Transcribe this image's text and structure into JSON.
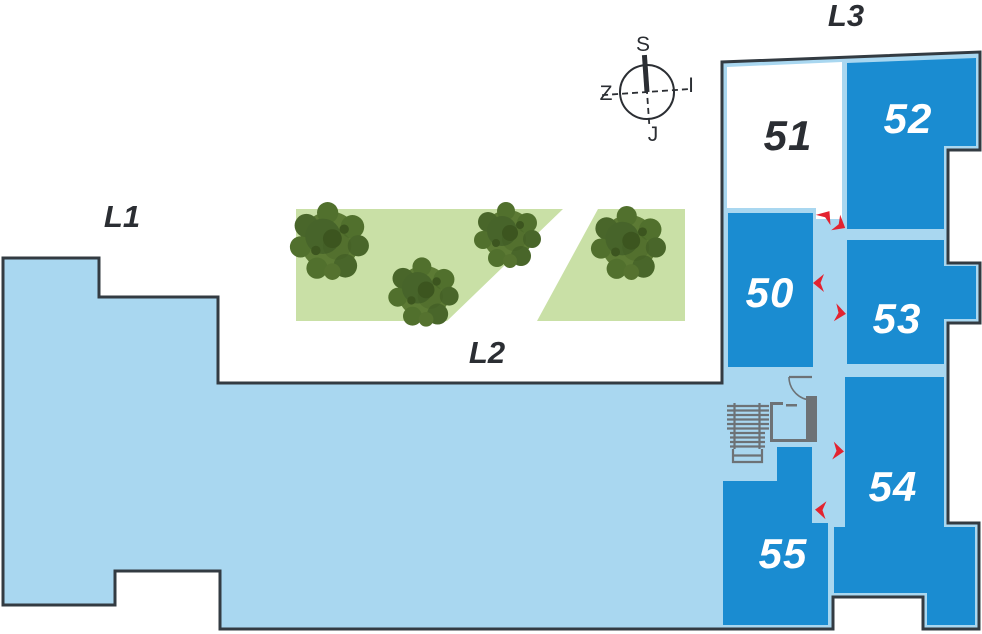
{
  "title": "Floor plan with numbered units",
  "area_labels": {
    "l1": "L1",
    "l2": "L2",
    "l3": "L3"
  },
  "compass": {
    "top": "S",
    "bottom": "J",
    "left": "Z",
    "right": "I"
  },
  "units": [
    {
      "id": "50",
      "label": "50",
      "fill": "blue"
    },
    {
      "id": "51",
      "label": "51",
      "fill": "white"
    },
    {
      "id": "52",
      "label": "52",
      "fill": "blue"
    },
    {
      "id": "53",
      "label": "53",
      "fill": "blue"
    },
    {
      "id": "54",
      "label": "54",
      "fill": "blue"
    },
    {
      "id": "55",
      "label": "55",
      "fill": "blue"
    }
  ],
  "icons": {
    "stairs": "stairs-icon",
    "elevator": "elevator-icon",
    "tree": "tree-icon",
    "door_arrow": "door-arrow-icon",
    "compass": "compass-rose-icon"
  },
  "colors": {
    "unit_blue": "#1a8cd1",
    "floor_light_blue": "#a9d7f0",
    "outline_dark": "#333b42",
    "lawn_green": "#c9e0a6",
    "arrow_red": "#e32330",
    "fixture_gray": "#6d7276",
    "text_dark": "#2b2e33",
    "text_white": "#ffffff",
    "background": "#ffffff"
  }
}
